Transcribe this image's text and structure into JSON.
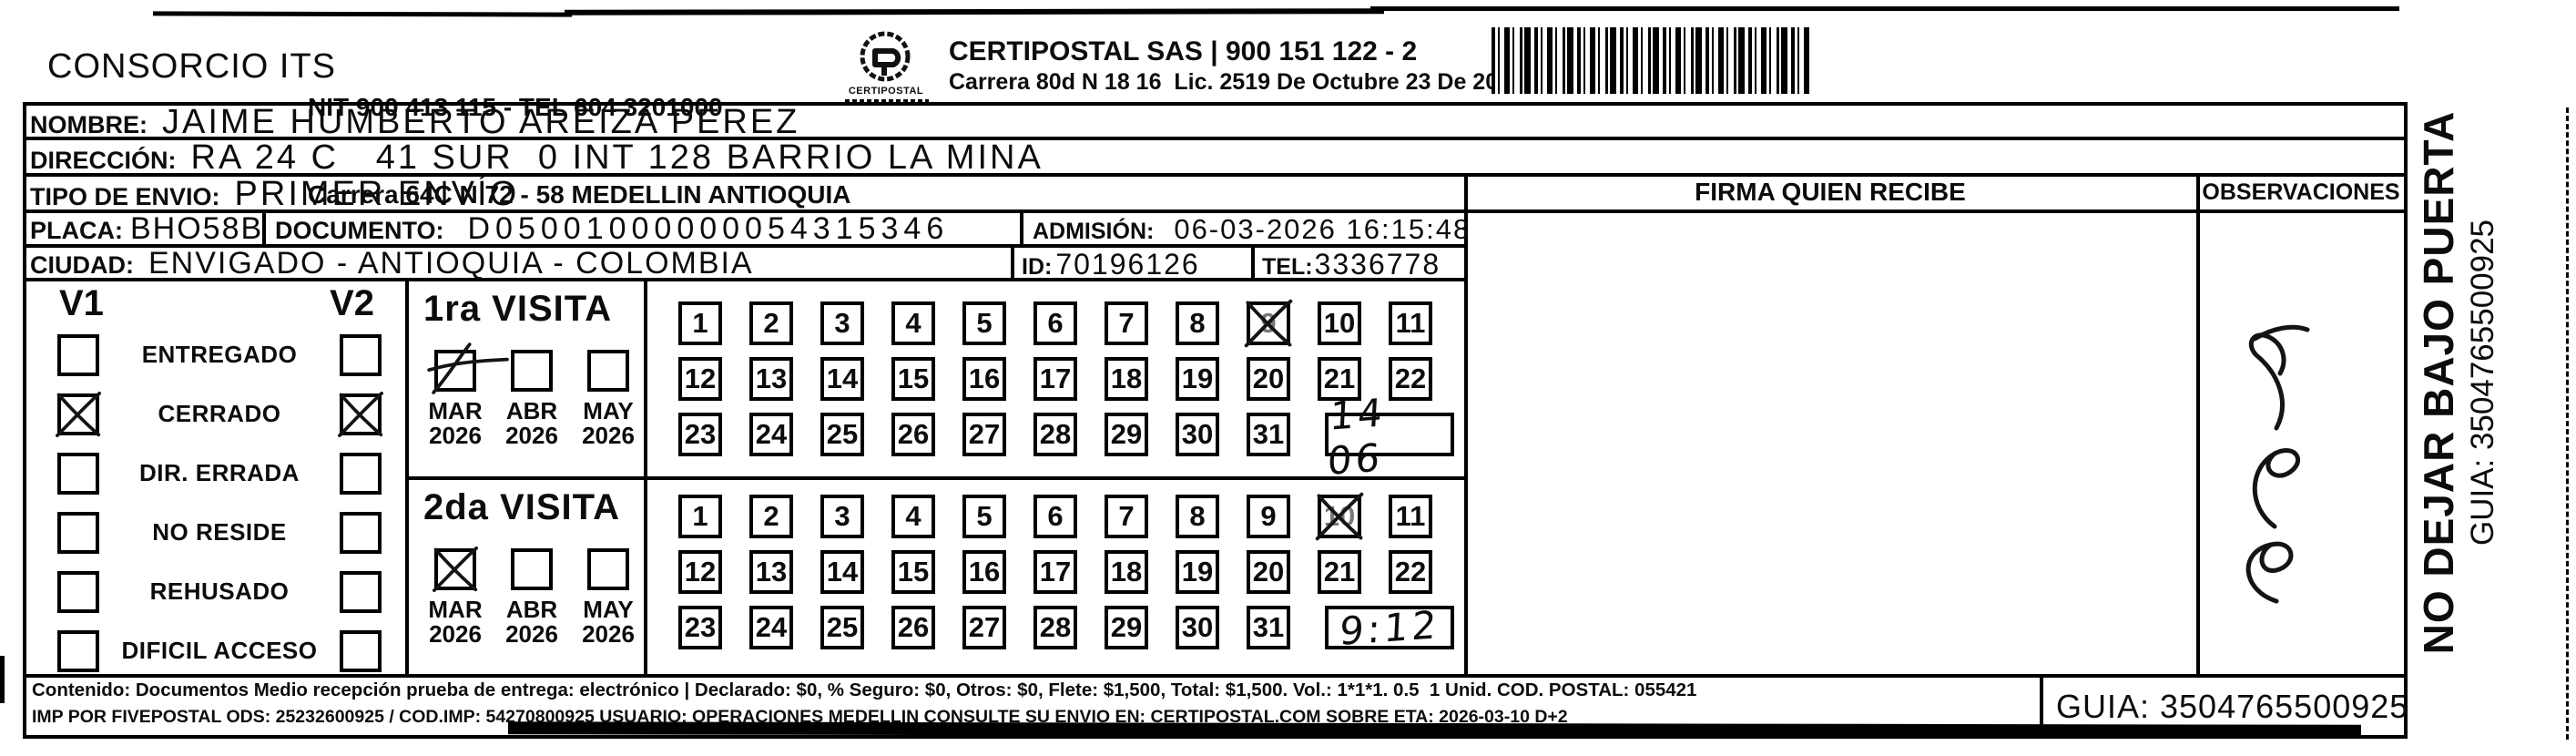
{
  "colors": {
    "ink": "#0c0c0c",
    "paper": "#ffffff"
  },
  "header": {
    "company": "CONSORCIO ITS",
    "nit_line1": "NIT 900 413 115 - TEL 604 3201000",
    "nit_line2": "Carrera 64C N 72 - 58 MEDELLIN ANTIOQUIA",
    "logo_text": "CERTIPOSTAL",
    "carrier_line1": "CERTIPOSTAL SAS | 900 151 122 - 2",
    "carrier_line2": "Carrera 80d N 18 16  Lic. 2519 De Octubre 23 De 2015"
  },
  "recipient": {
    "nombre_label": "NOMBRE:",
    "nombre": "JAIME HUMBERTO AREIZA PEREZ",
    "direccion_label": "DIRECCIÓN:",
    "direccion": "RA 24 C   41 SUR  0 INT 128 BARRIO LA MINA",
    "tipo_label": "TIPO DE ENVIO:",
    "tipo": "PRIMER ENVÍO",
    "placa_label": "PLACA:",
    "placa": "BHO58B",
    "documento_label": "DOCUMENTO:",
    "documento": "D05001000000054315346",
    "admision_label": "ADMISIÓN:",
    "admision": "06-03-2026 16:15:48",
    "ciudad_label": "CIUDAD:",
    "ciudad": "ENVIGADO - ANTIOQUIA - COLOMBIA",
    "id_label": "ID:",
    "id": "70196126",
    "tel_label": "TEL:",
    "tel": "3336778"
  },
  "status": {
    "v1_label": "V1",
    "v2_label": "V2",
    "options": [
      {
        "label": "ENTREGADO",
        "v1": false,
        "v2": false
      },
      {
        "label": "CERRADO",
        "v1": true,
        "v2": true
      },
      {
        "label": "DIR. ERRADA",
        "v1": false,
        "v2": false
      },
      {
        "label": "NO RESIDE",
        "v1": false,
        "v2": false
      },
      {
        "label": "REHUSADO",
        "v1": false,
        "v2": false
      },
      {
        "label": "DIFICIL ACCESO",
        "v1": false,
        "v2": false
      }
    ]
  },
  "visits": [
    {
      "title": "1ra VISITA",
      "months": [
        {
          "month": "MAR",
          "year": "2026",
          "checked": true,
          "mark": "slash-tail"
        },
        {
          "month": "ABR",
          "year": "2026",
          "checked": false
        },
        {
          "month": "MAY",
          "year": "2026",
          "checked": false
        }
      ],
      "day_rows": [
        [
          1,
          2,
          3,
          4,
          5,
          6,
          7,
          8,
          9,
          10,
          11
        ],
        [
          12,
          13,
          14,
          15,
          16,
          17,
          18,
          19,
          20,
          21,
          22
        ],
        [
          23,
          24,
          25,
          26,
          27,
          28,
          29,
          30,
          31
        ]
      ],
      "crossed_days": [
        9
      ],
      "time_note": "14 06"
    },
    {
      "title": "2da VISITA",
      "months": [
        {
          "month": "MAR",
          "year": "2026",
          "checked": true,
          "mark": "x"
        },
        {
          "month": "ABR",
          "year": "2026",
          "checked": false
        },
        {
          "month": "MAY",
          "year": "2026",
          "checked": false
        }
      ],
      "day_rows": [
        [
          1,
          2,
          3,
          4,
          5,
          6,
          7,
          8,
          9,
          10,
          11
        ],
        [
          12,
          13,
          14,
          15,
          16,
          17,
          18,
          19,
          20,
          21,
          22
        ],
        [
          23,
          24,
          25,
          26,
          27,
          28,
          29,
          30,
          31
        ]
      ],
      "crossed_days": [
        10
      ],
      "time_note": "9:12"
    }
  ],
  "signature": {
    "firma_header": "FIRMA QUIEN RECIBE",
    "observaciones_header": "OBSERVACIONES",
    "observaciones_note": "3 (illegible handwriting)"
  },
  "side_label": {
    "line1": "NO DEJAR BAJO PUERTA",
    "line2": "GUIA: 3504765500925"
  },
  "footer": {
    "line1": "Contenido: Documentos Medio recepción prueba de entrega: electrónico | Declarado: $0, % Seguro: $0, Otros: $0, Flete: $1,500, Total: $1,500. Vol.: 1*1*1. 0.5  1 Unid. COD. POSTAL: 055421",
    "line2": "IMP POR FIVEPOSTAL ODS: 25232600925 / COD.IMP: 54270800925 USUARIO: OPERACIONES MEDELLIN CONSULTE SU ENVIO EN: CERTIPOSTAL.COM SOBRE ETA: 2026-03-10 D+2",
    "guia": "GUIA: 3504765500925"
  }
}
